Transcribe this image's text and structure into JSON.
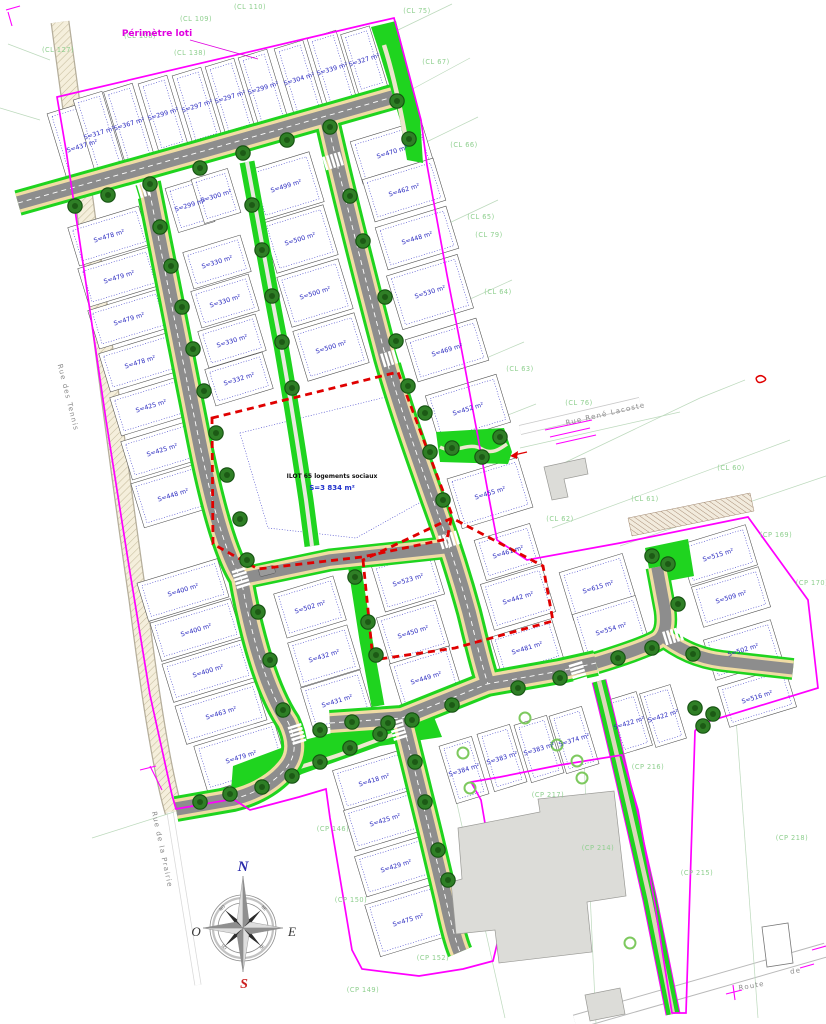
{
  "map": {
    "annotations": {
      "perimetre_loti": "Périmètre loti",
      "ilot_line1": "ILOT 65 logements sociaux",
      "ilot_line2": "S=3 834 m²"
    },
    "compass": {
      "north": "N",
      "south": "S",
      "east": "E",
      "west": "O",
      "ne": "NE",
      "se": "SE",
      "so": "SO",
      "no": "NO"
    },
    "streets": [
      {
        "name": "Rue des Tennis",
        "x": 66,
        "y": 398,
        "angle": 76
      },
      {
        "name": "Rue de la Prairie",
        "x": 160,
        "y": 850,
        "angle": 78
      },
      {
        "name": "Rue René Lacoste",
        "x": 606,
        "y": 416,
        "angle": -13
      },
      {
        "name": "Route",
        "x": 752,
        "y": 988,
        "angle": -10
      },
      {
        "name": "de",
        "x": 796,
        "y": 973,
        "angle": -10
      }
    ],
    "cadastral_labels": [
      {
        "text": "(CL 110)",
        "x": 250,
        "y": 9
      },
      {
        "text": "(CL 109)",
        "x": 196,
        "y": 21
      },
      {
        "text": "(CL 108)",
        "x": 140,
        "y": 38
      },
      {
        "text": "(CL 127)",
        "x": 58,
        "y": 52
      },
      {
        "text": "(CL 138)",
        "x": 190,
        "y": 55
      },
      {
        "text": "(CL 75)",
        "x": 417,
        "y": 13
      },
      {
        "text": "(CL 67)",
        "x": 436,
        "y": 64
      },
      {
        "text": "(CL 66)",
        "x": 464,
        "y": 147
      },
      {
        "text": "(CL 65)",
        "x": 481,
        "y": 219
      },
      {
        "text": "(CL 79)",
        "x": 489,
        "y": 237
      },
      {
        "text": "(CL 64)",
        "x": 498,
        "y": 294
      },
      {
        "text": "(CL 63)",
        "x": 520,
        "y": 371
      },
      {
        "text": "(CL 76)",
        "x": 579,
        "y": 405
      },
      {
        "text": "(CL 60)",
        "x": 731,
        "y": 470
      },
      {
        "text": "(CL 61)",
        "x": 645,
        "y": 501
      },
      {
        "text": "(CL 62)",
        "x": 560,
        "y": 521
      },
      {
        "text": "(CP 169)",
        "x": 776,
        "y": 537
      },
      {
        "text": "(CP 170)",
        "x": 812,
        "y": 585
      },
      {
        "text": "(CP 216)",
        "x": 648,
        "y": 769
      },
      {
        "text": "(CP 217)",
        "x": 548,
        "y": 797
      },
      {
        "text": "(CP 218)",
        "x": 792,
        "y": 840
      },
      {
        "text": "(CP 215)",
        "x": 697,
        "y": 875
      },
      {
        "text": "(CP 214)",
        "x": 598,
        "y": 850
      },
      {
        "text": "(CP 146)",
        "x": 333,
        "y": 831
      },
      {
        "text": "(CP 150)",
        "x": 351,
        "y": 902
      },
      {
        "text": "(CP 152)",
        "x": 433,
        "y": 960
      },
      {
        "text": "(CP 149)",
        "x": 363,
        "y": 992
      }
    ],
    "lot_clusters": [
      {
        "angle": -17,
        "w": 30,
        "h": 72,
        "lots": [
          {
            "label": "S=437 m²",
            "x": 82,
            "y": 146,
            "w": 48,
            "h": 82
          },
          {
            "label": "S=317 m²",
            "x": 99,
            "y": 133,
            "h": 78
          },
          {
            "label": "S=367 m²",
            "x": 129,
            "y": 124,
            "h": 76
          },
          {
            "label": "S=299 m²",
            "x": 163,
            "y": 114
          },
          {
            "label": "S=297 m²",
            "x": 197,
            "y": 106
          },
          {
            "label": "S=297 m²",
            "x": 230,
            "y": 97
          },
          {
            "label": "S=299 m²",
            "x": 263,
            "y": 88
          },
          {
            "label": "S=304 m²",
            "x": 299,
            "y": 79
          },
          {
            "label": "S=339 m²",
            "x": 332,
            "y": 69
          },
          {
            "label": "S=327 m²",
            "x": 364,
            "y": 60,
            "h": 62
          }
        ]
      },
      {
        "angle": -17,
        "w": 74,
        "h": 40,
        "lots": [
          {
            "label": "S=478 m²",
            "x": 109,
            "y": 236
          },
          {
            "label": "S=479 m²",
            "x": 119,
            "y": 277
          },
          {
            "label": "S=479 m²",
            "x": 129,
            "y": 319
          },
          {
            "label": "S=478 m²",
            "x": 140,
            "y": 362
          },
          {
            "label": "S=425 m²",
            "x": 151,
            "y": 406
          },
          {
            "label": "S=425 m²",
            "x": 162,
            "y": 450
          },
          {
            "label": "S=448 m²",
            "x": 173,
            "y": 495,
            "h": 46
          }
        ]
      },
      {
        "angle": -17,
        "w": 60,
        "h": 38,
        "lots": [
          {
            "label": "S=299 m²",
            "x": 190,
            "y": 205,
            "w": 38,
            "h": 46
          },
          {
            "label": "S=300 m²",
            "x": 216,
            "y": 196,
            "w": 38,
            "h": 46
          },
          {
            "label": "S=330 m²",
            "x": 217,
            "y": 262
          },
          {
            "label": "S=330 m²",
            "x": 225,
            "y": 301
          },
          {
            "label": "S=330 m²",
            "x": 232,
            "y": 341
          },
          {
            "label": "S=332 m²",
            "x": 239,
            "y": 379
          }
        ]
      },
      {
        "angle": -17,
        "w": 64,
        "h": 52,
        "lots": [
          {
            "label": "S=499 m²",
            "x": 286,
            "y": 186
          },
          {
            "label": "S=500 m²",
            "x": 300,
            "y": 239
          },
          {
            "label": "S=500 m²",
            "x": 315,
            "y": 293
          },
          {
            "label": "S=500 m²",
            "x": 331,
            "y": 347
          }
        ]
      },
      {
        "angle": -17,
        "w": 74,
        "h": 44,
        "lots": [
          {
            "label": "S=470 m²",
            "x": 392,
            "y": 152
          },
          {
            "label": "S=462 m²",
            "x": 404,
            "y": 190
          },
          {
            "label": "S=448 m²",
            "x": 417,
            "y": 238
          },
          {
            "label": "S=530 m²",
            "x": 430,
            "y": 292,
            "h": 56
          },
          {
            "label": "S=469 m²",
            "x": 447,
            "y": 350
          },
          {
            "label": "S=452 m²",
            "x": 468,
            "y": 409,
            "h": 50
          },
          {
            "label": "S=455 m²",
            "x": 490,
            "y": 493,
            "h": 52
          }
        ]
      },
      {
        "angle": -17,
        "w": 58,
        "h": 42,
        "lots": [
          {
            "label": "S=461 m²",
            "x": 508,
            "y": 552
          },
          {
            "label": "S=442 m²",
            "x": 518,
            "y": 598,
            "w": 64,
            "h": 48
          },
          {
            "label": "S=481 m²",
            "x": 527,
            "y": 648,
            "w": 64
          }
        ]
      },
      {
        "angle": -17,
        "w": 84,
        "h": 40,
        "lots": [
          {
            "label": "S=400 m²",
            "x": 183,
            "y": 590
          },
          {
            "label": "S=400 m²",
            "x": 196,
            "y": 630
          },
          {
            "label": "S=400 m²",
            "x": 208,
            "y": 671
          },
          {
            "label": "S=463 m²",
            "x": 221,
            "y": 713
          },
          {
            "label": "S=479 m²",
            "x": 241,
            "y": 757,
            "h": 48
          }
        ]
      },
      {
        "angle": -17,
        "w": 62,
        "h": 46,
        "lots": [
          {
            "label": "S=502 m²",
            "x": 310,
            "y": 607
          },
          {
            "label": "S=432 m²",
            "x": 324,
            "y": 656
          },
          {
            "label": "S=431 m²",
            "x": 337,
            "y": 701
          }
        ]
      },
      {
        "angle": -17,
        "w": 62,
        "h": 48,
        "lots": [
          {
            "label": "S=523 m²",
            "x": 408,
            "y": 580
          },
          {
            "label": "S=450 m²",
            "x": 413,
            "y": 632
          },
          {
            "label": "S=449 m²",
            "x": 426,
            "y": 678
          }
        ]
      },
      {
        "angle": -17,
        "w": 66,
        "h": 50,
        "lots": [
          {
            "label": "S=615 m²",
            "x": 598,
            "y": 587
          },
          {
            "label": "S=554 m²",
            "x": 611,
            "y": 629
          }
        ]
      },
      {
        "angle": -17,
        "w": 70,
        "h": 42,
        "lots": [
          {
            "label": "S=515 m²",
            "x": 718,
            "y": 555
          },
          {
            "label": "S=509 m²",
            "x": 731,
            "y": 597
          },
          {
            "label": "S=502 m²",
            "x": 743,
            "y": 650
          },
          {
            "label": "S=516 m²",
            "x": 757,
            "y": 697
          }
        ]
      },
      {
        "angle": -17,
        "w": 32,
        "h": 56,
        "lots": [
          {
            "label": "S=422 m²",
            "x": 629,
            "y": 723
          },
          {
            "label": "S=422 m²",
            "x": 663,
            "y": 716
          }
        ]
      },
      {
        "angle": -17,
        "w": 34,
        "h": 60,
        "lots": [
          {
            "label": "S=384 m²",
            "x": 464,
            "y": 770
          },
          {
            "label": "S=383 m²",
            "x": 502,
            "y": 758
          },
          {
            "label": "S=383 m²",
            "x": 539,
            "y": 749
          },
          {
            "label": "S=374 m²",
            "x": 574,
            "y": 740
          }
        ]
      },
      {
        "angle": -17,
        "w": 74,
        "h": 42,
        "lots": [
          {
            "label": "S=418 m²",
            "x": 374,
            "y": 780
          },
          {
            "label": "S=425 m²",
            "x": 385,
            "y": 820
          },
          {
            "label": "S=429 m²",
            "x": 396,
            "y": 866
          },
          {
            "label": "S=475 m²",
            "x": 408,
            "y": 920,
            "h": 54
          }
        ]
      }
    ],
    "trees_dark": [
      [
        75,
        206
      ],
      [
        108,
        195
      ],
      [
        150,
        184
      ],
      [
        200,
        168
      ],
      [
        243,
        153
      ],
      [
        287,
        140
      ],
      [
        330,
        127
      ],
      [
        397,
        101
      ],
      [
        409,
        139
      ],
      [
        160,
        227
      ],
      [
        171,
        266
      ],
      [
        182,
        307
      ],
      [
        193,
        349
      ],
      [
        204,
        391
      ],
      [
        216,
        433
      ],
      [
        227,
        475
      ],
      [
        240,
        519
      ],
      [
        247,
        560
      ],
      [
        258,
        612
      ],
      [
        270,
        660
      ],
      [
        283,
        710
      ],
      [
        252,
        205
      ],
      [
        262,
        250
      ],
      [
        272,
        296
      ],
      [
        282,
        342
      ],
      [
        292,
        388
      ],
      [
        350,
        196
      ],
      [
        363,
        241
      ],
      [
        385,
        297
      ],
      [
        396,
        341
      ],
      [
        408,
        386
      ],
      [
        425,
        413
      ],
      [
        430,
        452
      ],
      [
        443,
        500
      ],
      [
        452,
        448
      ],
      [
        482,
        457
      ],
      [
        500,
        437
      ],
      [
        355,
        577
      ],
      [
        368,
        622
      ],
      [
        376,
        655
      ],
      [
        320,
        730
      ],
      [
        352,
        722
      ],
      [
        388,
        723
      ],
      [
        452,
        705
      ],
      [
        518,
        688
      ],
      [
        560,
        678
      ],
      [
        415,
        762
      ],
      [
        425,
        802
      ],
      [
        438,
        850
      ],
      [
        448,
        880
      ],
      [
        652,
        556
      ],
      [
        668,
        564
      ],
      [
        678,
        604
      ],
      [
        652,
        648
      ],
      [
        618,
        658
      ],
      [
        693,
        654
      ],
      [
        695,
        708
      ],
      [
        713,
        714
      ],
      [
        703,
        726
      ],
      [
        200,
        802
      ],
      [
        230,
        794
      ],
      [
        262,
        787
      ],
      [
        292,
        776
      ],
      [
        320,
        762
      ],
      [
        350,
        748
      ],
      [
        380,
        734
      ],
      [
        412,
        720
      ]
    ],
    "trees_light": [
      [
        463,
        753
      ],
      [
        470,
        788
      ],
      [
        525,
        718
      ],
      [
        557,
        745
      ],
      [
        577,
        761
      ],
      [
        582,
        778
      ],
      [
        630,
        943
      ]
    ],
    "crosswalks": [
      [
        140,
        191,
        -17
      ],
      [
        333,
        161,
        -17
      ],
      [
        391,
        358,
        -17
      ],
      [
        449,
        540,
        -17
      ],
      [
        241,
        578,
        73
      ],
      [
        297,
        734,
        73
      ],
      [
        398,
        730,
        73
      ],
      [
        578,
        672,
        73
      ],
      [
        673,
        636,
        -17
      ]
    ]
  }
}
